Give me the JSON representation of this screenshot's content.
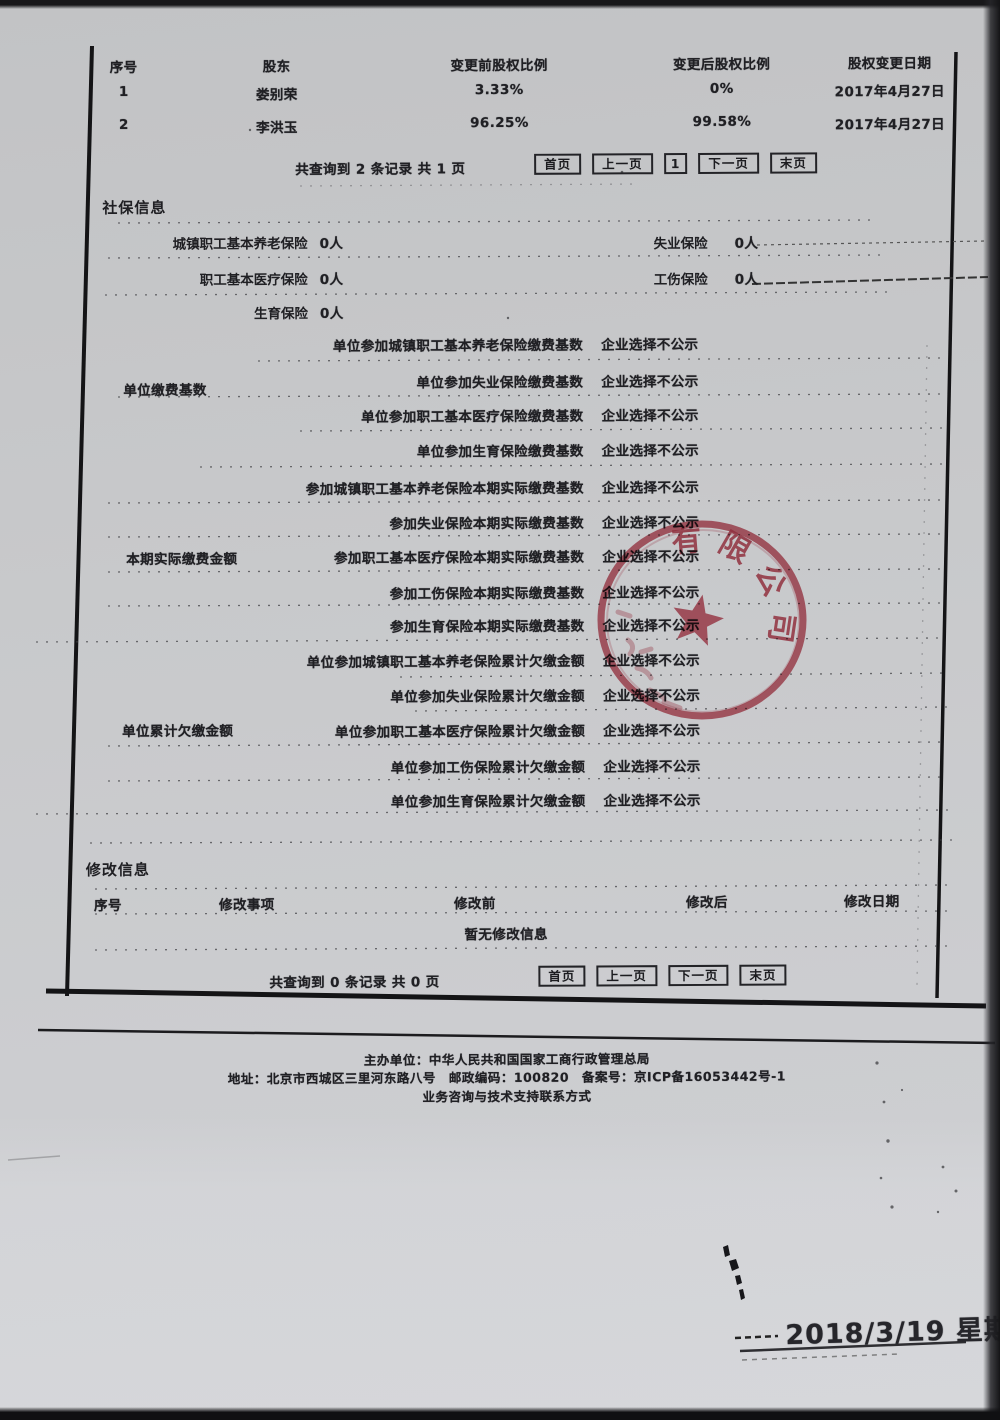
{
  "shareholders": {
    "headers": [
      "序号",
      "股东",
      "变更前股权比例",
      "变更后股权比例",
      "股权变更日期"
    ],
    "rows": [
      {
        "no": "1",
        "name": "娄别荣",
        "before": "3.33%",
        "after": "0%",
        "date": "2017年4月27日"
      },
      {
        "no": "2",
        "name": "李洪玉",
        "before": "96.25%",
        "after": "99.58%",
        "date": "2017年4月27日"
      }
    ],
    "pagination": {
      "summary": "共查询到 2 条记录 共 1 页",
      "first": "首页",
      "prev": "上一页",
      "page": "1",
      "next": "下一页",
      "last": "末页"
    }
  },
  "social": {
    "title": "社保信息",
    "fields": [
      {
        "label": "城镇职工基本养老保险",
        "value": "0人"
      },
      {
        "label": "失业保险",
        "value": "0人"
      },
      {
        "label": "职工基本医疗保险",
        "value": "0人"
      },
      {
        "label": "工伤保险",
        "value": "0人"
      },
      {
        "label": "生育保险",
        "value": "0人"
      }
    ],
    "groups": [
      {
        "name": "单位缴费基数",
        "rows": [
          {
            "label": "单位参加城镇职工基本养老保险缴费基数",
            "value": "企业选择不公示"
          },
          {
            "label": "单位参加失业保险缴费基数",
            "value": "企业选择不公示"
          },
          {
            "label": "单位参加职工基本医疗保险缴费基数",
            "value": "企业选择不公示"
          },
          {
            "label": "单位参加生育保险缴费基数",
            "value": "企业选择不公示"
          }
        ]
      },
      {
        "name": "本期实际缴费金额",
        "rows": [
          {
            "label": "参加城镇职工基本养老保险本期实际缴费基数",
            "value": "企业选择不公示"
          },
          {
            "label": "参加失业保险本期实际缴费基数",
            "value": "企业选择不公示"
          },
          {
            "label": "参加职工基本医疗保险本期实际缴费基数",
            "value": "企业选择不公示"
          },
          {
            "label": "参加工伤保险本期实际缴费基数",
            "value": "企业选择不公示"
          },
          {
            "label": "参加生育保险本期实际缴费基数",
            "value": "企业选择不公示"
          }
        ]
      },
      {
        "name": "单位累计欠缴金额",
        "rows": [
          {
            "label": "单位参加城镇职工基本养老保险累计欠缴金额",
            "value": "企业选择不公示"
          },
          {
            "label": "单位参加失业保险累计欠缴金额",
            "value": "企业选择不公示"
          },
          {
            "label": "单位参加职工基本医疗保险累计欠缴金额",
            "value": "企业选择不公示"
          },
          {
            "label": "单位参加工伤保险累计欠缴金额",
            "value": "企业选择不公示"
          },
          {
            "label": "单位参加生育保险累计欠缴金额",
            "value": "企业选择不公示"
          }
        ]
      }
    ]
  },
  "modification": {
    "title": "修改信息",
    "headers": [
      "序号",
      "修改事项",
      "修改前",
      "修改后",
      "修改日期"
    ],
    "empty_text": "暂无修改信息",
    "pagination": {
      "summary": "共查询到 0 条记录 共 0 页",
      "first": "首页",
      "prev": "上一页",
      "next": "下一页",
      "last": "末页"
    }
  },
  "footer": {
    "line1": "主办单位：中华人民共和国国家工商行政管理总局",
    "line2": "地址：北京市西城区三里河东路八号　邮政编码：100820　备案号：京ICP备16053442号-1",
    "line3": "业务咨询与技术支持联系方式"
  },
  "stamp": {
    "visible_text": "有限公司",
    "color": "#b2293a"
  },
  "print_date": "2018/3/19 星期一"
}
